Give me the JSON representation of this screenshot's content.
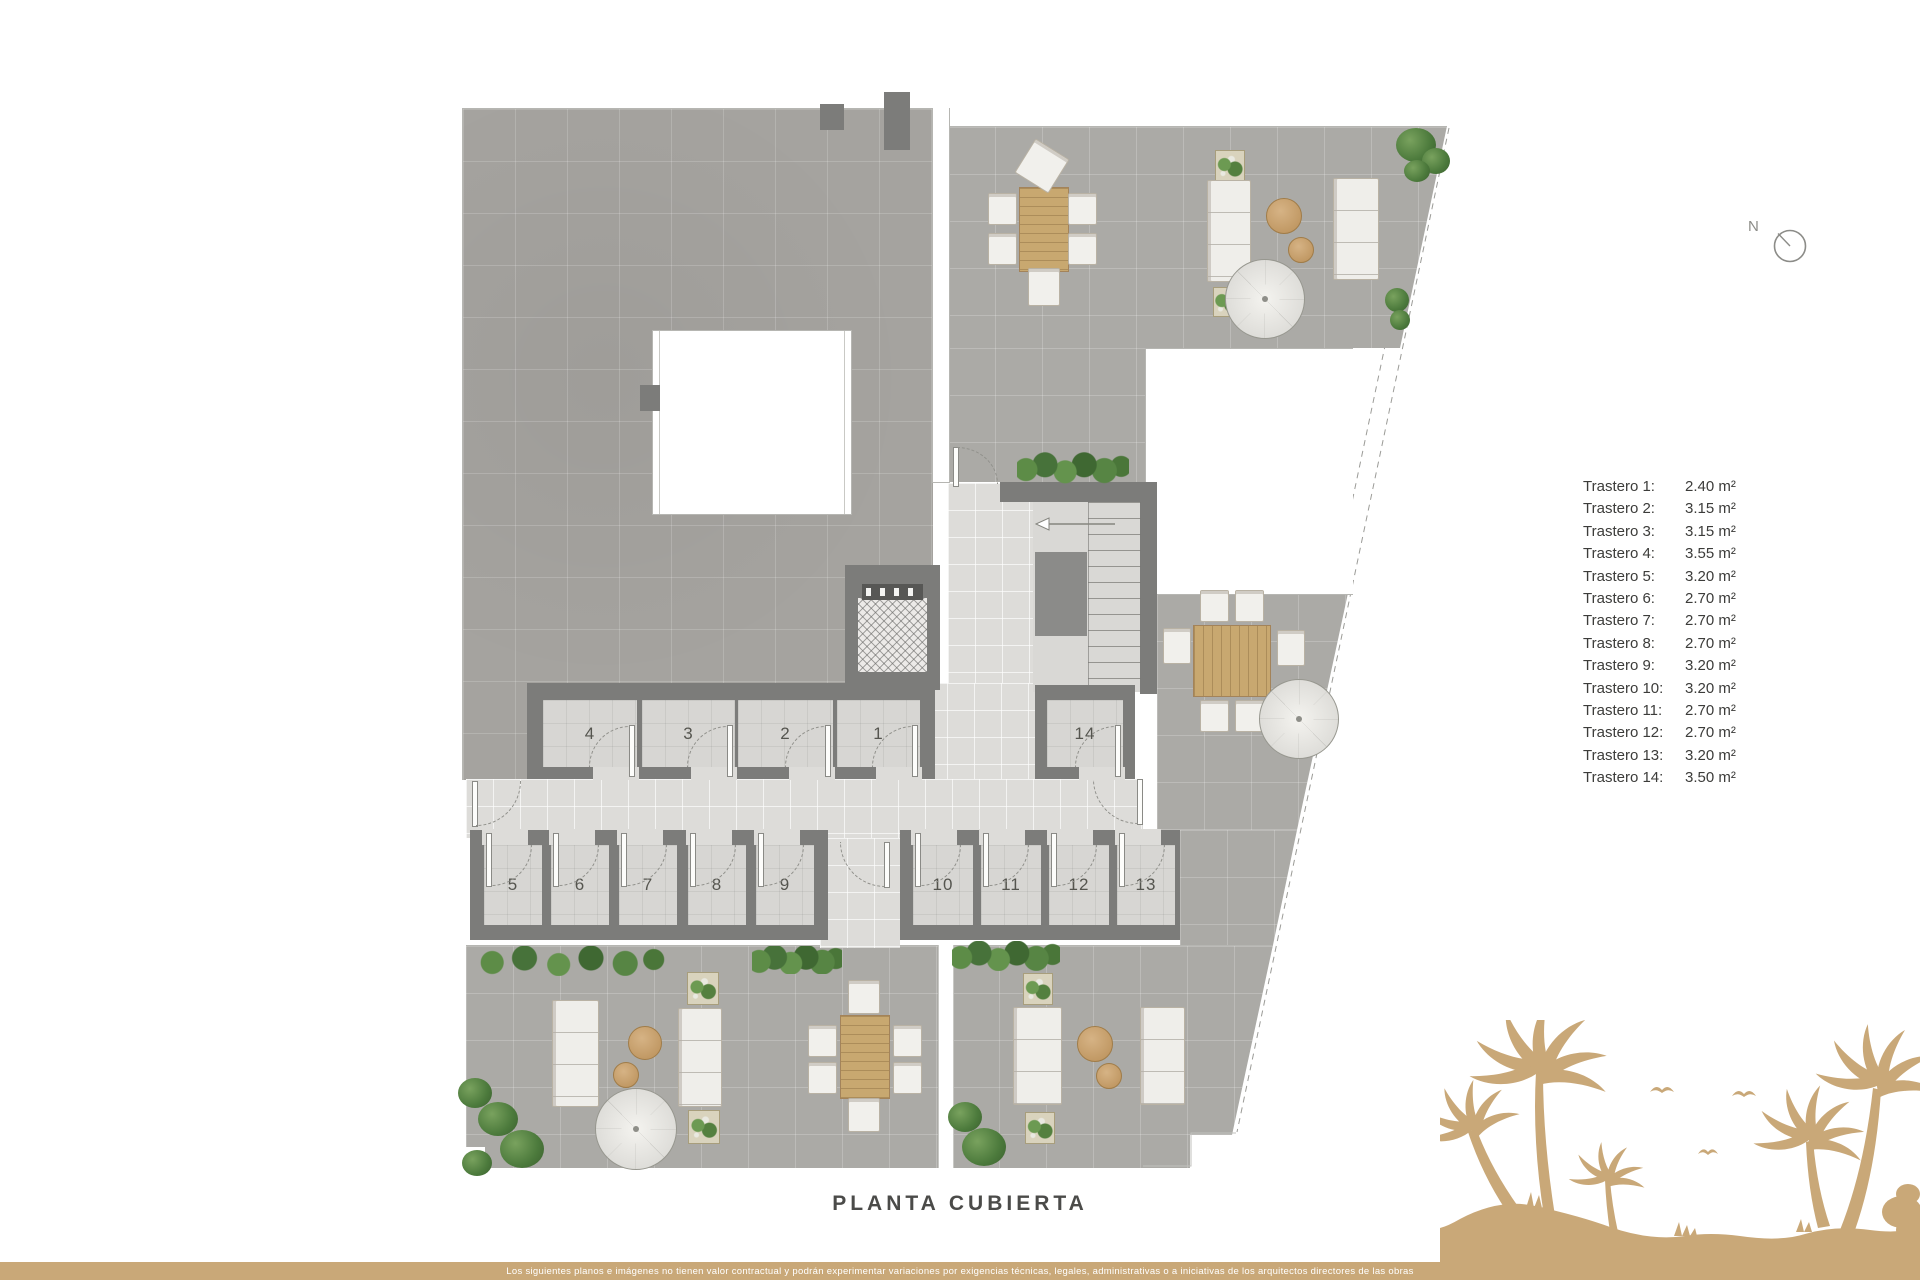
{
  "plan": {
    "title": "PLANTA CUBIERTA",
    "room_numbers": [
      "1",
      "2",
      "3",
      "4",
      "5",
      "6",
      "7",
      "8",
      "9",
      "10",
      "11",
      "12",
      "13",
      "14"
    ]
  },
  "legend": {
    "items": [
      {
        "label": "Trastero 1:",
        "value": "2.40 m²"
      },
      {
        "label": "Trastero 2:",
        "value": "3.15 m²"
      },
      {
        "label": "Trastero 3:",
        "value": "3.15 m²"
      },
      {
        "label": "Trastero 4:",
        "value": "3.55 m²"
      },
      {
        "label": "Trastero 5:",
        "value": "3.20 m²"
      },
      {
        "label": "Trastero 6:",
        "value": "2.70 m²"
      },
      {
        "label": "Trastero 7:",
        "value": "2.70 m²"
      },
      {
        "label": "Trastero 8:",
        "value": "2.70 m²"
      },
      {
        "label": "Trastero 9:",
        "value": "3.20 m²"
      },
      {
        "label": "Trastero 10:",
        "value": "3.20 m²"
      },
      {
        "label": "Trastero 11:",
        "value": "2.70 m²"
      },
      {
        "label": "Trastero 12:",
        "value": "2.70 m²"
      },
      {
        "label": "Trastero 13:",
        "value": "3.20 m²"
      },
      {
        "label": "Trastero 14:",
        "value": "3.50 m²"
      }
    ]
  },
  "compass": {
    "label": "N"
  },
  "footer": {
    "disclaimer": "Los siguientes planos e imágenes no tienen valor contractual y podrán experimentar variaciones por exigencias técnicas, legales, administrativas o a iniciativas de los arquitectos directores de las obras"
  },
  "colors": {
    "accent_tan": "#c9a878",
    "wall_gray": "#7c7c7a",
    "tile_gray": "#a5a39f",
    "plant_green": "#4c7a3c"
  }
}
